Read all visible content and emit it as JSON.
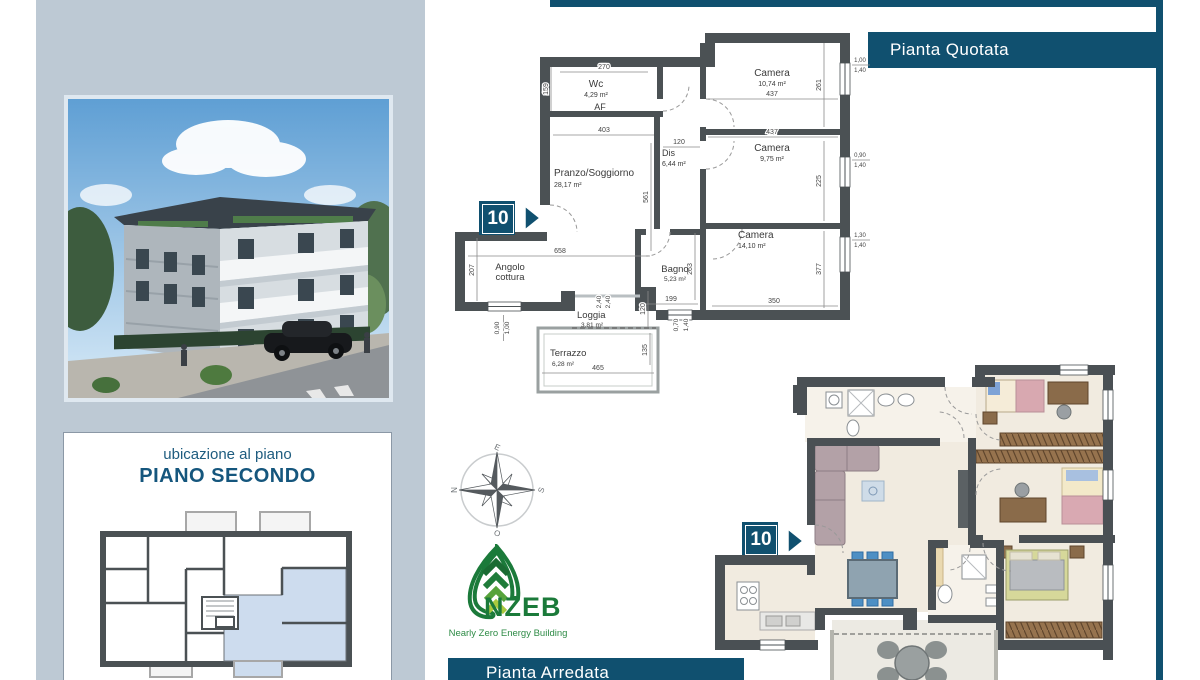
{
  "frame": {
    "quotata_title": "Pianta Quotata",
    "arredata_title": "Pianta Arredata"
  },
  "sidebar": {
    "location_label": "ubicazione al piano",
    "floor_label": "PIANO SECONDO"
  },
  "unit": {
    "badge": "10"
  },
  "compass": {
    "n": "N",
    "e": "E",
    "s": "S",
    "o": "O"
  },
  "nzeb": {
    "name": "NZEB",
    "tagline": "Nearly Zero Energy Building"
  },
  "colors": {
    "accent_teal": "#10506F",
    "panel_bluegray": "#BDC9D4",
    "wall_gray": "#4B5154",
    "unit_highlight": "#CDDCEE",
    "floor_beige": "#F1EBE0",
    "nzeb_green": "#1B7A3A"
  },
  "plan": {
    "rooms": {
      "wc": {
        "name": "Wc",
        "area": "4,29 m²"
      },
      "af": {
        "name": "AF"
      },
      "camera1": {
        "name": "Camera",
        "area": "10,74 m²"
      },
      "camera2": {
        "name": "Camera",
        "area": "9,75 m²"
      },
      "camera3": {
        "name": "Camera",
        "area": "14,10 m²"
      },
      "dis": {
        "name": "Dis",
        "area": "6,44 m²"
      },
      "soggiorno": {
        "name": "Pranzo/Soggiorno",
        "area": "28,17 m²"
      },
      "cottura": {
        "name1": "Angolo",
        "name2": "cottura"
      },
      "bagno": {
        "name": "Bagno",
        "area": "5,23 m²"
      },
      "loggia": {
        "name": "Loggia",
        "area": "3,81 m²"
      },
      "terrazzo": {
        "name": "Terrazzo",
        "area": "6,28 m²"
      }
    },
    "dims": {
      "wc_w": "270",
      "wc_h": "159",
      "sog_w": "403",
      "sog_h": "561",
      "dis_w": "120",
      "cam1_w": "437",
      "cam1_h": "261",
      "cam2_w": "437",
      "cam2_h": "225",
      "cam3_w": "350",
      "cam3_h": "377",
      "cott_w": "658",
      "cott_h": "207",
      "bagno_w": "199",
      "bagno_h": "263",
      "log_a": "2,40",
      "log_b": "2,40",
      "log_h": "120",
      "ter_w": "465",
      "ter_h": "135",
      "win_sx_a": "0,90",
      "win_sx_b": "1,00",
      "win_bg_a": "0,70",
      "win_bg_b": "1,40",
      "win_c1_a": "1,00",
      "win_c1_b": "1,40",
      "win_c2_a": "0,90",
      "win_c2_b": "1,40",
      "win_c3_a": "1,30",
      "win_c3_b": "1,40"
    }
  }
}
